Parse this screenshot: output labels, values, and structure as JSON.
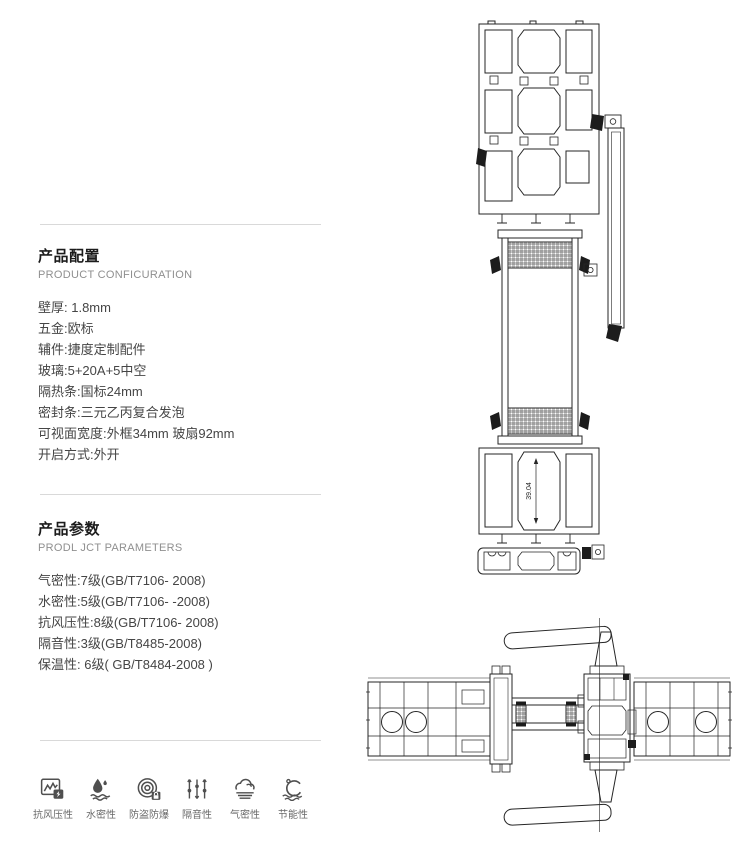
{
  "product_config": {
    "title": "产品配置",
    "subtitle": "PRODUCT CONFICURATION",
    "items": [
      "壁厚: 1.8mm",
      "五金:欧标",
      "辅件:捷度定制配件",
      "玻璃:5+20A+5中空",
      "隔热条:国标24mm",
      "密封条:三元乙丙复合发泡",
      "可视面宽度:外框34mm 玻扇92mm",
      "开启方式:外开"
    ]
  },
  "product_params": {
    "title": "产品参数",
    "subtitle": "PRODL JCT PARAMETERS",
    "items": [
      "气密性:7级(GB/T7106- 2008)",
      "水密性:5级(GB/T7106- -2008)",
      "抗风压性:8级(GB/T7106- 2008)",
      "隔音性:3级(GB/T8485-2008)",
      "保温性: 6级( GB/T8484-2008 )"
    ]
  },
  "features": {
    "items": [
      {
        "icon": "wind-pressure-icon",
        "label": "抗风压性"
      },
      {
        "icon": "water-tightness-icon",
        "label": "水密性"
      },
      {
        "icon": "burglar-proof-icon",
        "label": "防盗防爆"
      },
      {
        "icon": "sound-insulation-icon",
        "label": "隔音性"
      },
      {
        "icon": "air-tightness-icon",
        "label": "气密性"
      },
      {
        "icon": "energy-saving-icon",
        "label": "节能性"
      }
    ]
  },
  "drawings": {
    "section_dimension_label": "39.04",
    "line_color": "#262626"
  }
}
